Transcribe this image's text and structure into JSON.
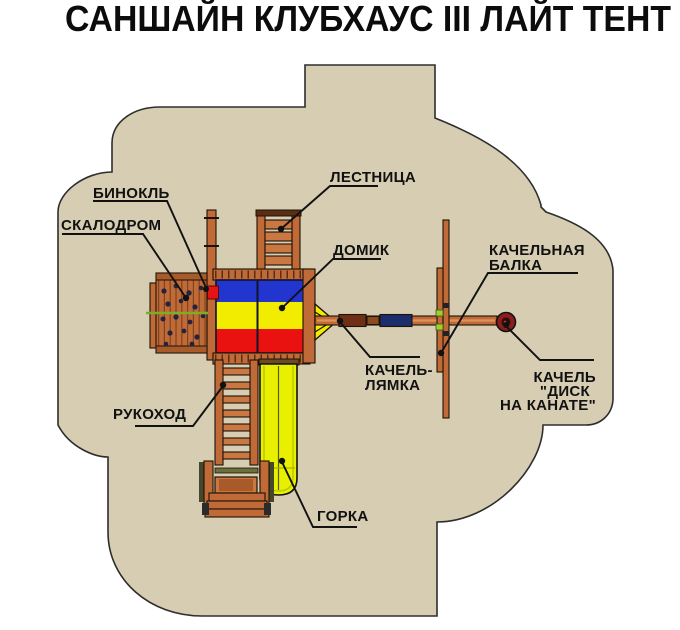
{
  "title": "САНШАЙН КЛУБХАУС III ЛАЙТ ТЕНТ",
  "labels": {
    "binoculars": "БИНОКЛЬ",
    "climbing_wall": "СКАЛОДРОМ",
    "ladder": "ЛЕСТНИЦА",
    "house": "ДОМИК",
    "swing_beam": {
      "line1": "КАЧЕЛЬНАЯ",
      "line2": "БАЛКА"
    },
    "strap_swing": {
      "line1": "КАЧЕЛЬ-",
      "line2": "ЛЯМКА"
    },
    "disc_swing": {
      "line1": "КАЧЕЛЬ",
      "line2": "\"ДИСК",
      "line3": "НА КАНАТЕ\""
    },
    "monkey_bars": "РУКОХОД",
    "slide": "ГОРКА"
  },
  "colors": {
    "safety_zone": "#d6cdb2",
    "outline": "#2e2e2e",
    "wood": "#c06a38",
    "tent_blue": "#2335cf",
    "tent_yellow": "#f2ec00",
    "tent_red": "#ea1111",
    "slide_yellow": "#e8f000",
    "strap_navy": "#1c2d6b",
    "strap_brown": "#6e2f16",
    "disc_red": "#8c1d1d",
    "binoculars_red": "#e31414",
    "rope_green": "#7aae26"
  }
}
